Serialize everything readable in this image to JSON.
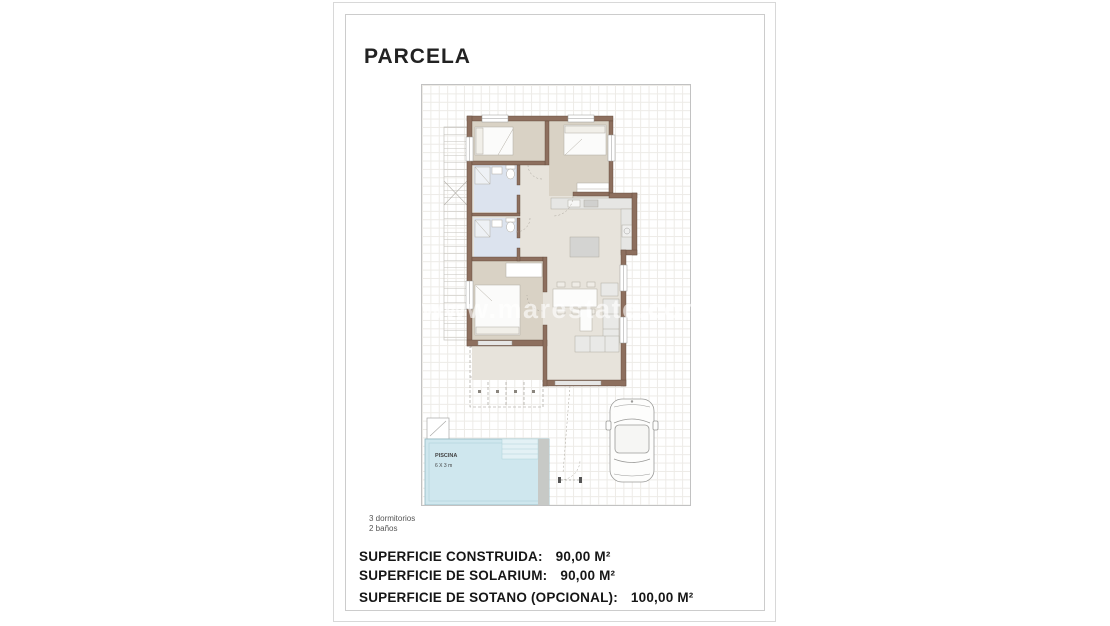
{
  "page": {
    "title": "PARCELA",
    "watermark": "www.marestate.com"
  },
  "plan": {
    "pool_label": "PISCINA",
    "pool_size": "6 X 3 m"
  },
  "notes": {
    "bedrooms": "3 dormitorios",
    "bathrooms": "2 baños"
  },
  "summary": {
    "rows": [
      {
        "label": "SUPERFICIE CONSTRUIDA:",
        "value": "90,00 M²"
      },
      {
        "label": "SUPERFICIE DE SOLARIUM:",
        "value": "90,00 M²"
      },
      {
        "label": "SUPERFICIE DE SOTANO (OPCIONAL):",
        "value": "100,00 M²"
      }
    ]
  },
  "colors": {
    "wall": "#8d6f5e",
    "bedroom_floor": "#d9d2c5",
    "hall_floor": "#e7e3db",
    "bath_floor": "#dce3ee",
    "pool_water": "#cfe7ee",
    "grid_line": "#edebe7"
  }
}
